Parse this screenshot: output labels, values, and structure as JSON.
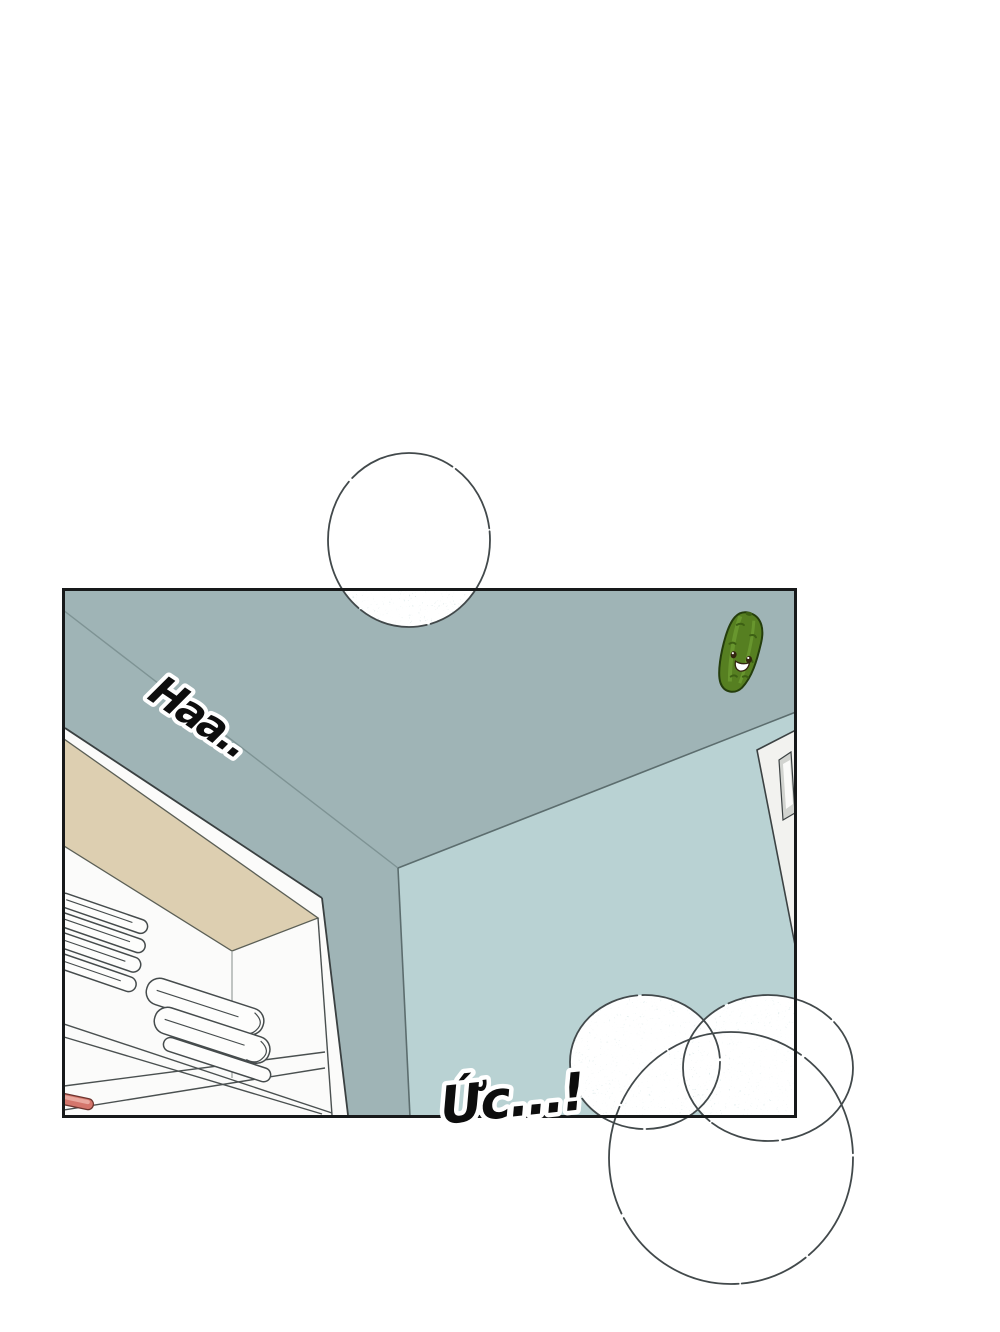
{
  "scene": {
    "kind": "webtoon-comic-panel",
    "background_color": "#ffffff"
  },
  "sfx": {
    "breath": "Haa..",
    "strain": "Ức...!"
  },
  "panel": {
    "border_color": "#17191a"
  },
  "colors": {
    "ceiling_wall": "#9fb4b6",
    "right_wall": "#b9d2d3",
    "wall_line": "#5c6d6e",
    "seam_line": "#7e9394",
    "closet_white": "#fbfbfa",
    "closet_beige": "#ddcfb1",
    "door_white": "#f2f2ef",
    "door_molding": "#d2d4d0",
    "linework": "#454b4c",
    "bubble_outline": "#42494b",
    "bubble_fill_mid": "#dfeceb",
    "red_item": "#d4766c",
    "red_item_highlight": "#e9a89e",
    "pickle_body": "#567f21",
    "pickle_stripe": "#6b9a30",
    "pickle_dark": "#3d6014",
    "pickle_face": "#32250f"
  }
}
